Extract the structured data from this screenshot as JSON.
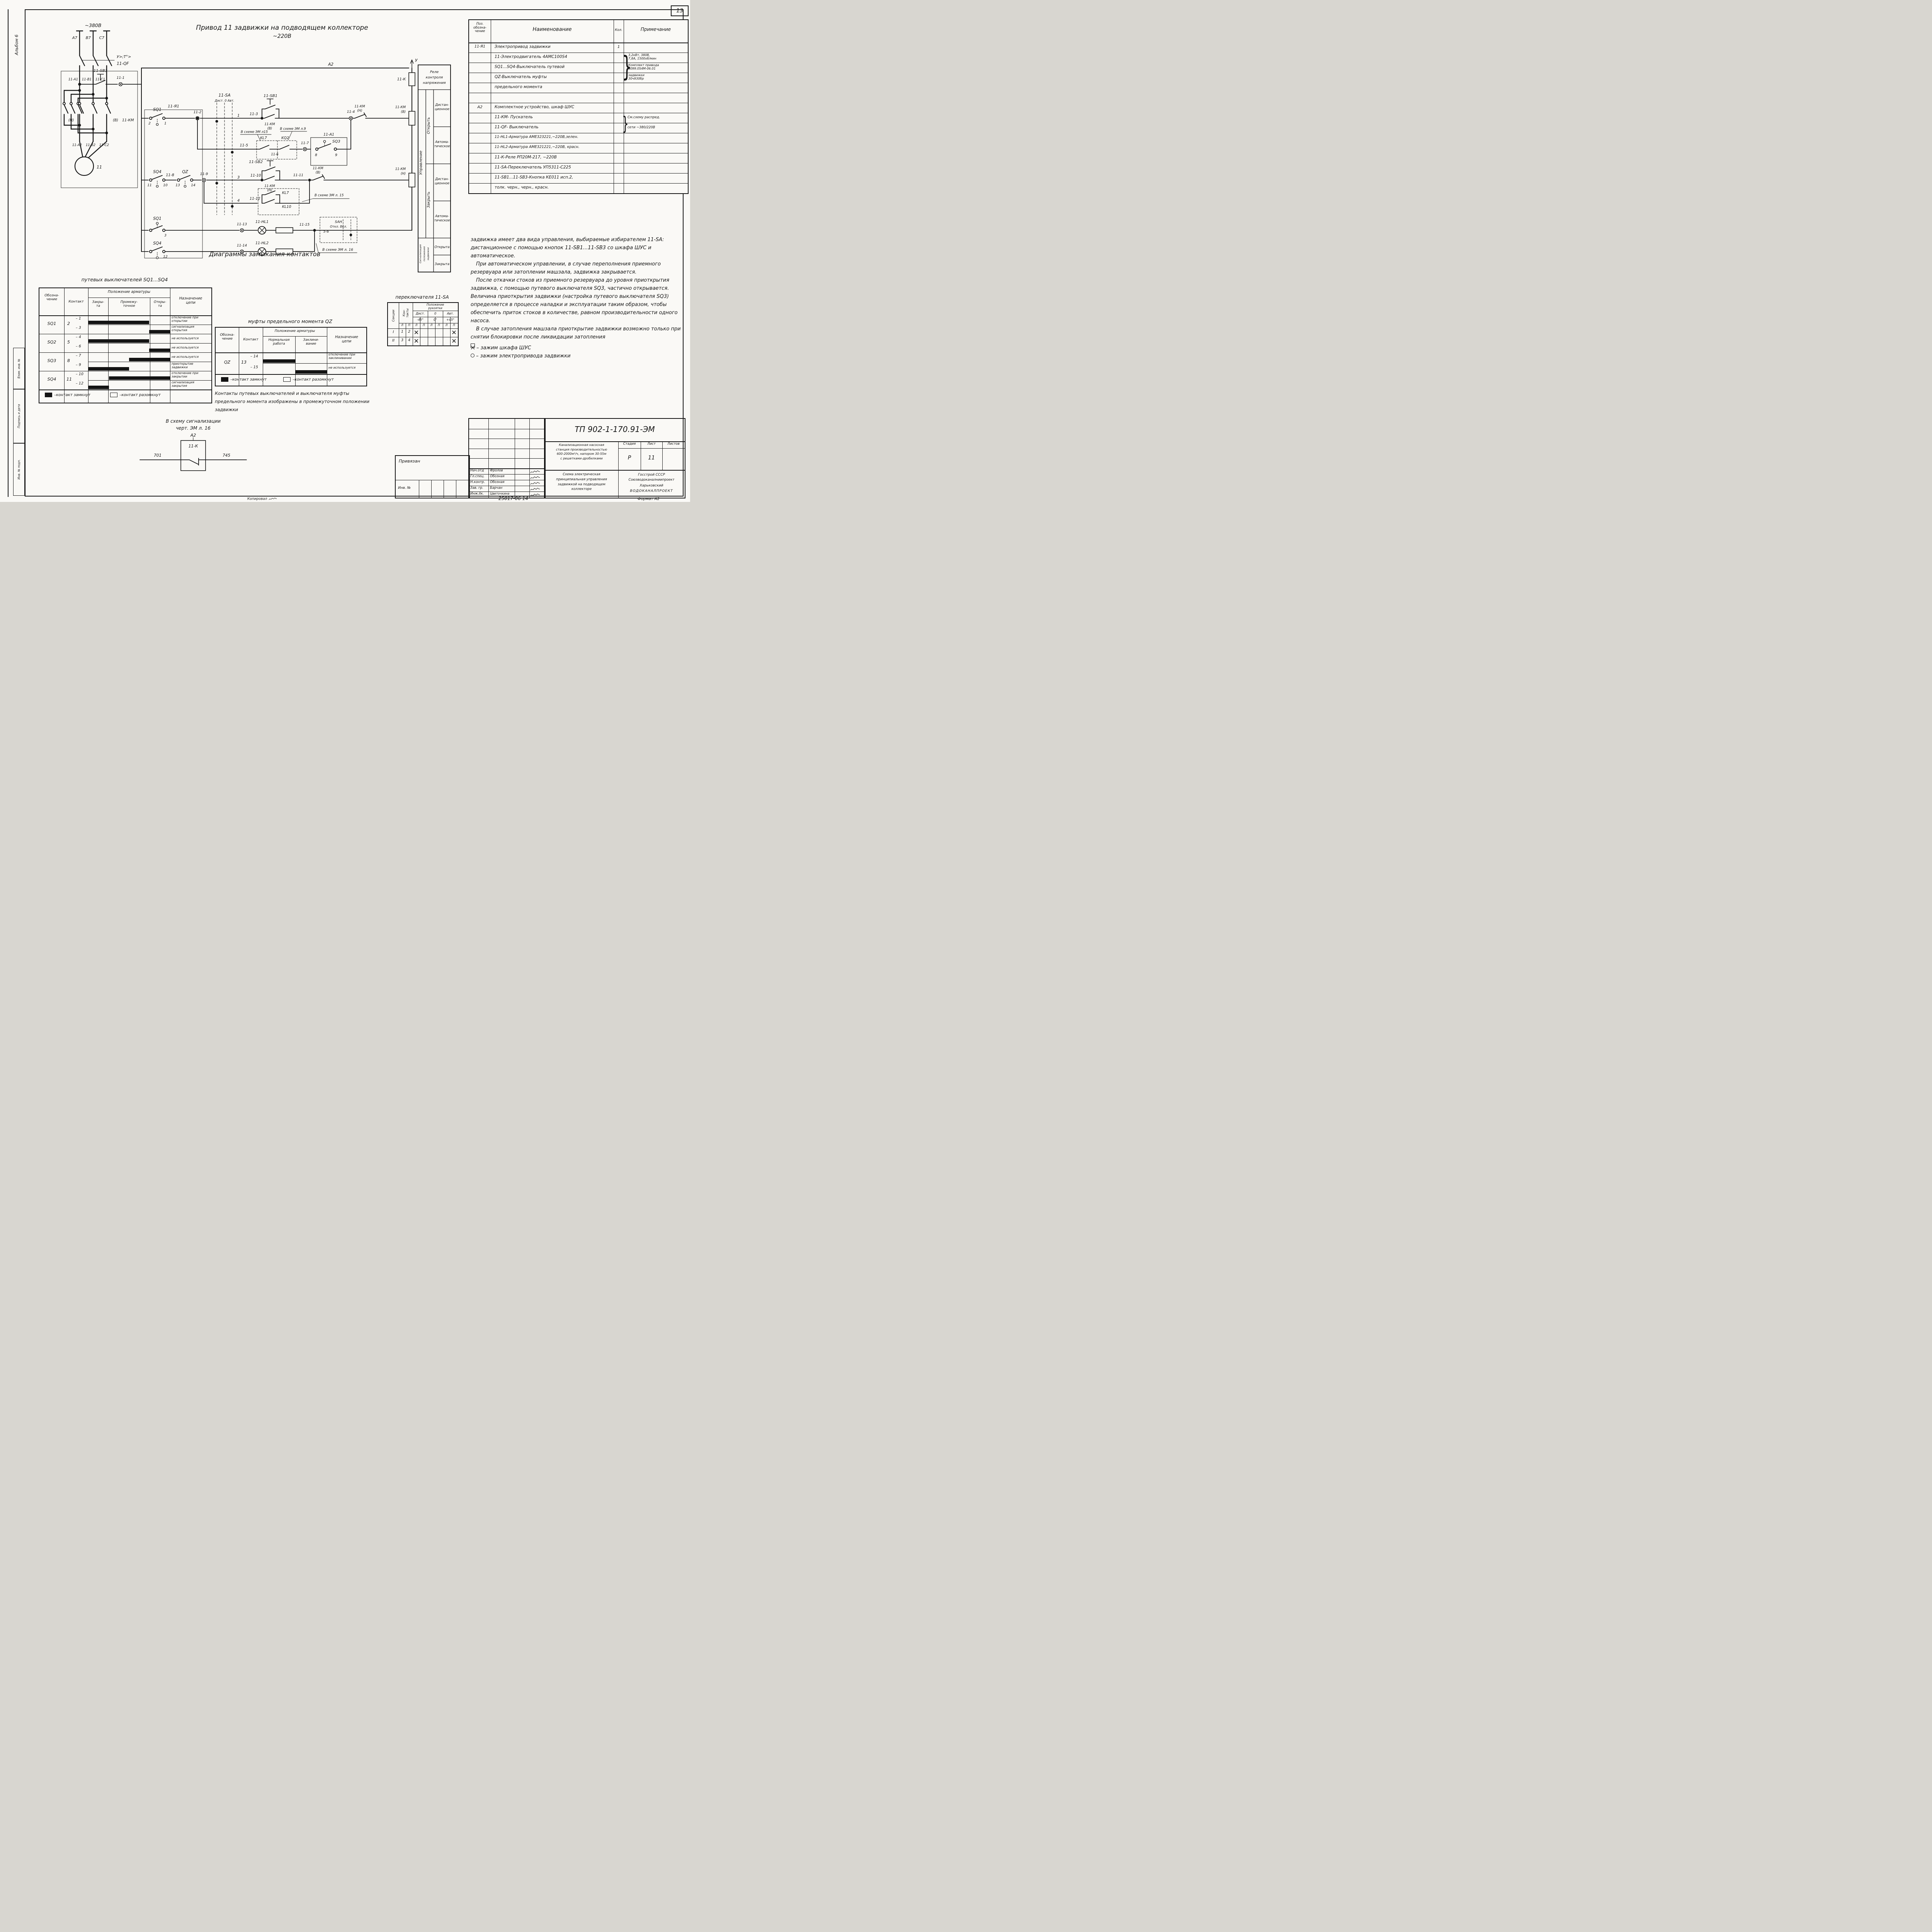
{
  "page": {
    "num": "13",
    "album": "Альбом 6",
    "s1": "Взам. инв. №",
    "s2": "Подпись и дата",
    "s3": "Инв. № подл.",
    "kop": "Копировал",
    "fmt": "Формат А2",
    "doc": "25017-06   14"
  },
  "sch": {
    "title1": "Привод 11 задвижки на подводящем коллекторе",
    "title2": "~220В",
    "l": {
      "v380": "~380В",
      "a7": "А7",
      "b7": "В7",
      "c7": "С7",
      "qf_note": "У>;Т°>",
      "qf": "11-QF",
      "a1": "11-А1",
      "b1": "11-В1",
      "c1": "11-С1",
      "n": "(Н)",
      "v": "(В)",
      "km": "11-КМ",
      "a2p": "11-А2",
      "b2p": "11-В2",
      "c2p": "11-С2",
      "motor": "11",
      "sb3": "11-SВ3",
      "t1": "11-1",
      "ja1": "11-Я1",
      "sq1": "SQ1",
      "k2": "2",
      "k1": "1",
      "t2": "11-2",
      "sa": "11-SА",
      "sa_pos": "Дист. 0 Авт.",
      "n1": "1",
      "n2": "2",
      "n3": "3",
      "n4": "4",
      "t3": "11-3",
      "sb1": "11-SВ1",
      "kmv1": "11-КМ",
      "kmv2": "(В)",
      "t4": "11-4",
      "kmn1": "11-КМ",
      "kmn2": "(Н)",
      "coil1a": "11-КМ",
      "coil1b": "(В)",
      "a2": "А2",
      "u": "У",
      "k": "11-К",
      "n15": "В схеме ЭМ л15",
      "n9": "В схеме ЭМ л.9",
      "kl7": "KL7",
      "kq2": "KQ2",
      "t5": "11-5",
      "t6": "11-6",
      "t7": "11-7",
      "ba1": "11-А1",
      "sq3": "SQ3",
      "k8": "8",
      "k9": "9",
      "sq4": "SQ4",
      "k11": "11",
      "k10": "10",
      "t8": "11-8",
      "qz": "QZ",
      "k13": "13",
      "k14": "14",
      "t9": "11-9",
      "t10": "11-10",
      "sb2": "11-SВ2",
      "hold1": "11-КМ",
      "hold2": "(Н)",
      "t11": "11-11",
      "nc1": "11-КМ",
      "nc2": "(В)",
      "coil3a": "11-КМ",
      "coil3b": "(Н)",
      "t12": "11-12",
      "kl7b": "KL7",
      "kl10": "KL10",
      "n15b": "В схеме ЭМ л. 15",
      "sq1b": "SQ1",
      "k3": "3",
      "t13": "11-13",
      "hl1": "11-HL1",
      "t15": "11-15",
      "san": "SАН",
      "san2": "Откл. Вкл.",
      "n56": "5-6",
      "n16": "В схеме ЭМ л. 16",
      "sq4b": "SQ4",
      "k12": "12",
      "t14": "11-14",
      "hl2": "11-HL2"
    },
    "ft": {
      "r1": "Реле",
      "r2": "контроля",
      "r3": "напряжения",
      "upr": "Управление",
      "open": "Открыть",
      "close": "Закрыть",
      "d1": "Дистан-",
      "d1b": "ционное",
      "a1": "Автома-",
      "a1b": "тическое",
      "d2": "Дистан-",
      "d2b": "ционное",
      "a2": "Автома-",
      "a2b": "тическое",
      "sig1": "Сигнализация",
      "sig2": "положения",
      "sig3": "задвижки",
      "opened": "Открыта",
      "closed": "Закрыта"
    }
  },
  "parts": {
    "hdr": {
      "pos": "Поз.\nобозна-\nчение",
      "name": "Наименование",
      "qty": "Кол.",
      "note": "Примечание"
    },
    "brace": "}",
    "rows": [
      {
        "pos": "11-Я1",
        "name": "Электропривод задвижки",
        "qty": "1",
        "note": ""
      },
      {
        "pos": "",
        "name": "11-Электродвигатель 4АМС100S4",
        "qty": "",
        "note": "3,2кВт, 380В,\n7,8А, 1500об/мин"
      },
      {
        "pos": "",
        "name": "SQ1...SQ4-Выключатель путевой",
        "qty": "",
        "note": "Комплект привода\n6099.0S4М-06.01"
      },
      {
        "pos": "",
        "name": "QZ-Выключатель муфты",
        "qty": "",
        "note": "задвижки\n30ч930бр"
      },
      {
        "pos": "",
        "name": "предельного момента",
        "qty": "",
        "note": ""
      },
      {
        "pos": "",
        "name": "",
        "qty": "",
        "note": ""
      },
      {
        "pos": "А2",
        "name": "Комплектное устройство, шкаф ШУС",
        "qty": "",
        "note": ""
      },
      {
        "pos": "",
        "name": "11-КМ- Пускатель",
        "qty": "",
        "note": "См.схему распред."
      },
      {
        "pos": "",
        "name": "11-QF- Выключатель",
        "qty": "",
        "note": "сети ~380/220В"
      },
      {
        "pos": "",
        "name": "11-HL1-Арматура АМЕ323221,~220В,зелен.",
        "qty": "",
        "note": ""
      },
      {
        "pos": "",
        "name": "11-HL2-Арматура АМЕ321221,~220В, красн.",
        "qty": "",
        "note": ""
      },
      {
        "pos": "",
        "name": "11-К-Реле РП20М-217, ~220В",
        "qty": "",
        "note": ""
      },
      {
        "pos": "",
        "name": "11-SА-Переключатель УП5311-С225",
        "qty": "",
        "note": ""
      },
      {
        "pos": "",
        "name": "11-SВ1...11-SВ3-Кнопка КЕ011 исп.2,",
        "qty": "",
        "note": ""
      },
      {
        "pos": "",
        "name": "толк. черн., черн., красн.",
        "qty": "",
        "note": ""
      }
    ]
  },
  "text": {
    "p1": "задвижка имеет два вида управления, выбираемые избирателем 11-SА: дистанционное с помощью кнопок 11-SВ1...11-SВ3 со шкафа ШУС и автоматическое.",
    "p2": "При автоматическом управлении, в случае переполнения приемного резервуара или затоплении машзала, задвижка закрывается.",
    "p3": "После откачки стоков из приемного резервуара до уровня приоткрытия задвижка, с помощью путевого выключателя SQ3, частично открывается. Величина приоткрытия задвижки (настройка путевого выключателя SQ3) определяется в процессе наладки и эксплуатации таким образом, чтобы обеспечить приток стоков в количестве, равном производительности одного насоса.",
    "p4": "В случае затопления машзала приоткрытие задвижки возможно только при снятии блокировки после ликвидации затопления",
    "b1": "– зажим шкафа ШУС",
    "b2": "– зажим электропривода задвижки"
  },
  "diag": {
    "title": "Диаграммы  замыкания  контактов",
    "sub1": "путевых  выключателей  SQ1...SQ4",
    "sub2": "муфты  предельного  момента  QZ",
    "sub3": "переключателя  11-SА",
    "legend_closed": "–контакт замкнут",
    "legend_open": "–контакт разомкнут",
    "t1": {
      "ob": "Обозна-\nчение",
      "kt": "Контакт",
      "pos": "Положение арматуры",
      "c1": "Закры-\nта",
      "c2": "Промежу-\nточное",
      "c3": "Откры-\nта",
      "nz": "Назначение\nцепи",
      "rows": [
        {
          "dev": "SQ1",
          "common": "2",
          "s1": "– 1",
          "s2": "– 3",
          "bar1": [
            0,
            0.745
          ],
          "bar2": [
            0.745,
            1
          ],
          "p1": "отключение при\nоткрытии",
          "p2": "сигнализация\nоткрытия"
        },
        {
          "dev": "SQ2",
          "common": "5",
          "s1": "– 4",
          "s2": "– 6",
          "bar1": [
            0,
            0.745
          ],
          "bar2": [
            0.745,
            1
          ],
          "p1": "не используется",
          "p2": "не используется"
        },
        {
          "dev": "SQ3",
          "common": "8",
          "s1": "– 7",
          "s2": "– 9",
          "bar1": [
            0.5,
            1
          ],
          "bar2": [
            0,
            0.5
          ],
          "p1": "не используется",
          "p2": "приоткрытие\nзадвижки"
        },
        {
          "dev": "SQ4",
          "common": "11",
          "s1": "– 10",
          "s2": "– 12",
          "bar1": [
            0.255,
            1
          ],
          "bar2": [
            0,
            0.255
          ],
          "p1": "отключение при\nзакрытии",
          "p2": "сигнализация\nзакрытия"
        }
      ]
    },
    "t2": {
      "ob": "Обозна-\nчение",
      "kt": "Контакт",
      "pos": "Положение арматуры",
      "c1": "Нормальная\nработа",
      "c2": "Заклини-\nвание",
      "nz": "Назначение\nцепи",
      "row": {
        "dev": "QZ",
        "common": "13",
        "s1": "– 14",
        "s2": "– 15",
        "bar1": [
          0,
          0.51
        ],
        "bar2": [
          0.51,
          1
        ],
        "p1": "отключение при\nзаклинивании",
        "p2": "не используется"
      }
    },
    "t3": {
      "sec": "Секции",
      "kt": "Кон-\nтакты",
      "pos": "Положение\nрукоятки",
      "g1": "Дист.",
      "g2": "0",
      "g3": "Авт.",
      "d1": "-45°",
      "d2": "0°",
      "d3": "+45°",
      "l": "Л",
      "p": "П",
      "rows": [
        {
          "s": "I",
          "k1": "1",
          "k2": "2",
          "m": [
            "✕",
            "",
            "",
            "",
            "",
            "✕"
          ]
        },
        {
          "s": "II",
          "k1": "3",
          "k2": "4",
          "m": [
            "✕",
            "",
            "",
            "",
            "",
            "✕"
          ]
        }
      ]
    },
    "note": "Контакты  путевых  выключателей  и  выключателя  муфты\nпредельного  момента  изображены  в  промежуточном  положении\nзадвижки",
    "sig": {
      "l1": "В  схему  сигнализации",
      "l2": "черт. ЭМ л. 16",
      "a2": "А2",
      "k": "11-К",
      "t701": "701",
      "t745": "745"
    }
  },
  "tb": {
    "tp": "ТП 902-1-170.91-ЭМ",
    "privyazan": "Привязан",
    "inv": "Инв. №",
    "roles": [
      {
        "r": "Нач.отд",
        "n": "Фролов"
      },
      {
        "r": "Гл.спец.",
        "n": "Обозная"
      },
      {
        "r": "Н.контр.",
        "n": "Обозная"
      },
      {
        "r": "Зав. гр.",
        "n": "Барчан"
      },
      {
        "r": "Инж.IIк.",
        "n": "Цветочкина"
      }
    ],
    "project": "Канализационная насосная\nстанция производительностью\n600-2000м³/ч, напором 30-55м\nс решетками-дробилками",
    "stadia": "Стадия",
    "list": "Лист",
    "listov": "Листов",
    "stadia_v": "Р",
    "list_v": "11",
    "scheme": "Схема  электрическая\nпринципиальная  управления\nзадвижкой  на  подводящем\nколлекторе",
    "org1": "Госстрой СССР",
    "org2": "Союзводоканалниипроект",
    "org3": "Харьковский",
    "org4": "ВОДОКАНАЛПРОЕКТ"
  }
}
